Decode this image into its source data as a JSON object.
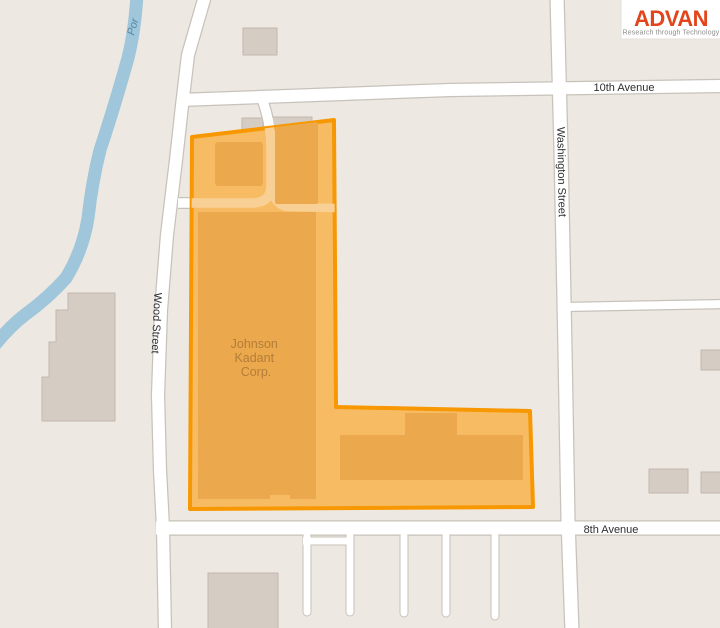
{
  "brand": {
    "name": "ADVAN",
    "tagline": "Research through Technology",
    "color": "#E2451B",
    "tagline_color": "#8C8C8C"
  },
  "map": {
    "background": "#EDE9E2",
    "road_color": "#FFFFFF",
    "road_casing": "#C7C2BA",
    "water_color": "#9FC6DA",
    "water_label_color": "#5588A8",
    "building_color": "#D5CDC4",
    "building_stroke": "#C2B8AE",
    "street_label_color": "#2E2E2E",
    "labels": {
      "avenue_10th": "10th Avenue",
      "washington": "Washington Street",
      "wood": "Wood Street",
      "avenue_8th": "8th Avenue",
      "river": "Por"
    },
    "parcel": {
      "name": "Johnson Kadant Corp.",
      "label_lines": [
        "Johnson",
        "Kadant",
        "Corp."
      ],
      "fill": "#F7BC63",
      "stroke": "#F79701",
      "building_fill": "#ECA84D",
      "driveway_tint": "#F8D096",
      "label_color": "#B27E38"
    }
  }
}
